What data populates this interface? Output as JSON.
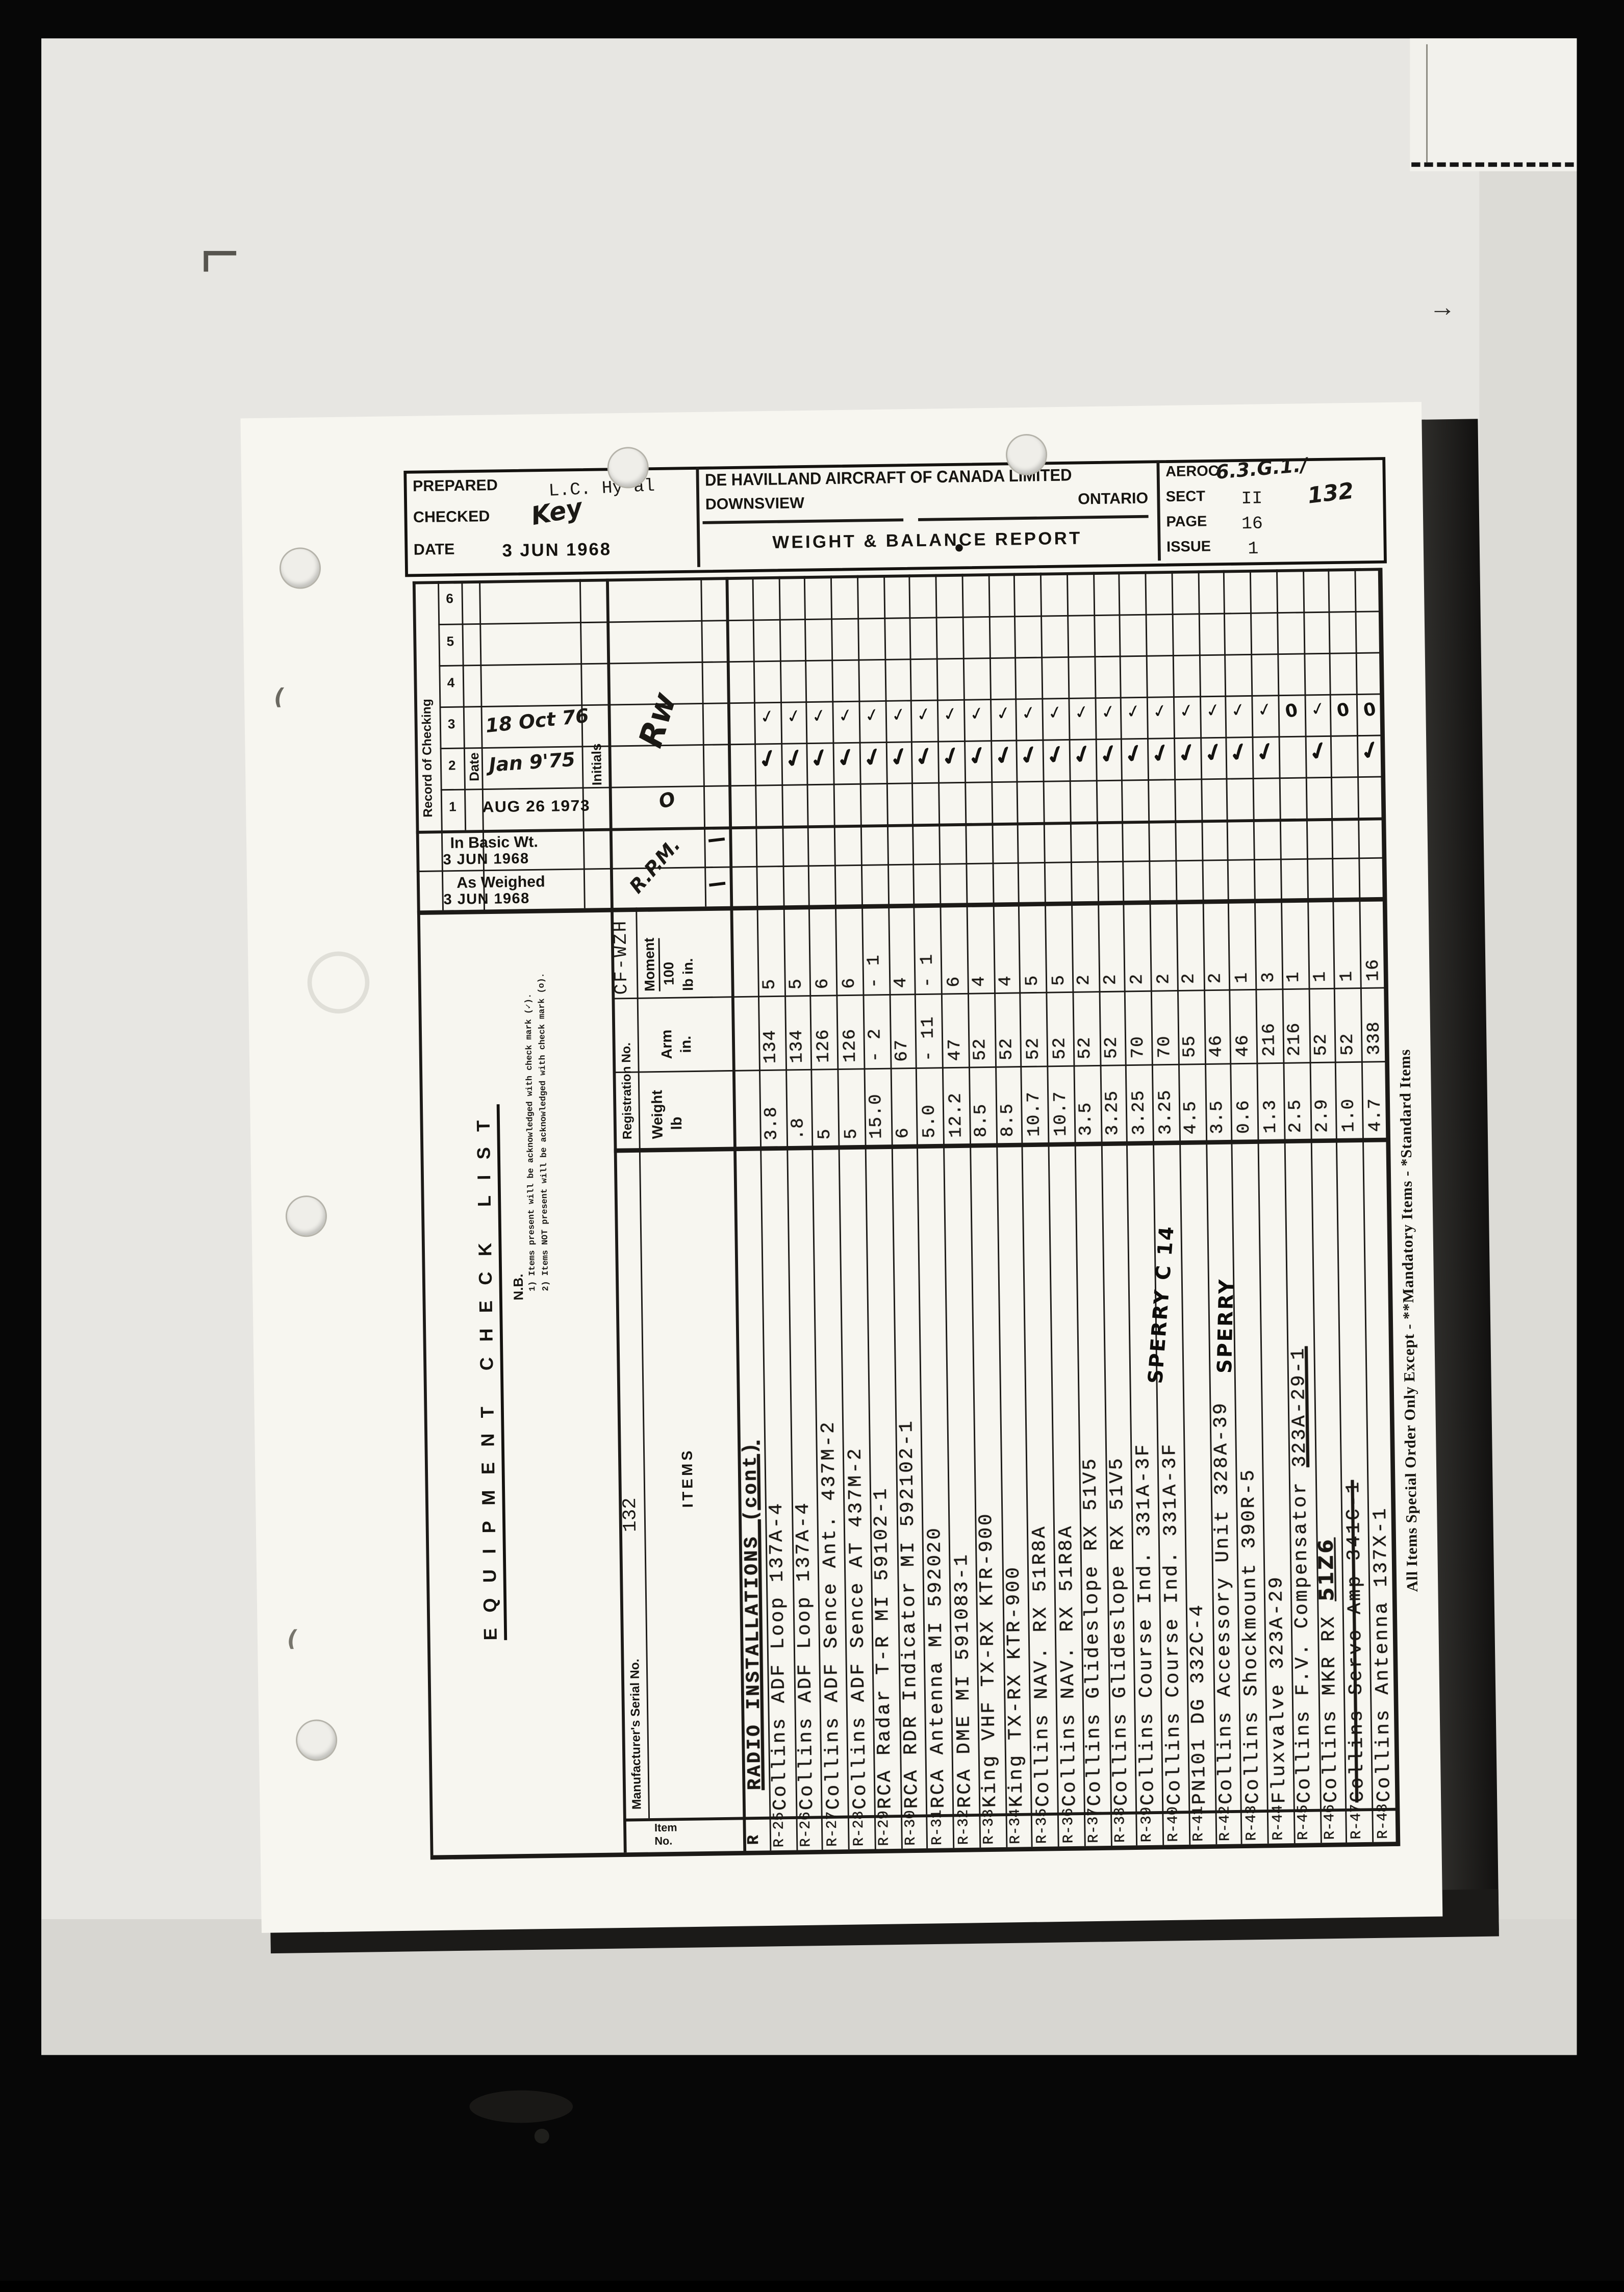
{
  "header": {
    "prepared_label": "PREPARED",
    "prepared_value": "L.C. Hy'al",
    "checked_label": "CHECKED",
    "checked_value": "Key",
    "date_label": "DATE",
    "date_value": "3 JUN 1968",
    "company": "DE HAVILLAND AIRCRAFT OF CANADA LIMITED",
    "city": "DOWNSVIEW",
    "province": "ONTARIO",
    "report_title": "WEIGHT & BALANCE REPORT",
    "ref_label": "AEROC",
    "ref_value": "6.3.G.1./",
    "sect_label": "SECT",
    "sect_value": "II",
    "serial_note": "132",
    "page_label": "PAGE",
    "page_value": "16",
    "issue_label": "ISSUE",
    "issue_value": "1"
  },
  "check_block": {
    "title": "Record of Checking",
    "col_numbers": [
      "6",
      "5",
      "4",
      "3",
      "2",
      "1"
    ],
    "date_label": "Date",
    "initials_label": "Initials",
    "date_3": "18 Oct 76",
    "date_2": "Jan 9'75",
    "date_1": "AUG 26 1973",
    "in_basic_label": "In Basic Wt.",
    "in_basic_date": "3 JUN 1968",
    "as_weighed_label": "As Weighed",
    "as_weighed_date": "3 JUN 1968",
    "initials_sig": "Rw",
    "initials_mark": "O",
    "initials_rpm": "R.P.M."
  },
  "notes": {
    "title": "EQUIPMENT CHECK LIST",
    "nb": "N.B.",
    "line1": "1) Items present will be acknowledged with check mark (✓).",
    "line2": "2) Items NOT present will be acknowledged with check mark (o)."
  },
  "marks": {
    "check_glyph": "✓",
    "zero_glyph": "0",
    "arrow": "→",
    "paren": "("
  },
  "table": {
    "registration_label": "Registration No.",
    "registration_value": "CF-WZH",
    "serial_label": "Manufacturer's Serial No.",
    "serial_value": "132",
    "items_label": "ITEMS",
    "item_no_label_1": "Item",
    "item_no_label_2": "No.",
    "weight_label1": "Weight",
    "weight_label2": "lb",
    "arm_label1": "Arm",
    "arm_label2": "in.",
    "moment_label1": "Moment",
    "moment_label2": "100",
    "moment_label3": "lb in.",
    "section_no": "R",
    "section_name": "RADIO INSTALLATIONS (cont)",
    "footnote": "All Items Special Order Only Except - **Mandatory Items - *Standard Items",
    "annotations": [
      {
        "text": "SPERRY C 14"
      },
      {
        "text": "SPERRY"
      }
    ],
    "items": [
      {
        "no": "R-25",
        "name": "Collins ADF Loop 137A-4",
        "weight": "3.8",
        "arm": "134",
        "moment": "5",
        "c76": "check",
        "c75": "check"
      },
      {
        "no": "R-26",
        "name": "Collins ADF Loop 137A-4",
        "weight": ".8",
        "arm": "134",
        "moment": "5",
        "c76": "check",
        "c75": "check"
      },
      {
        "no": "R-27",
        "name": "Collins ADF Sence Ant. 437M-2",
        "weight": "5",
        "arm": "126",
        "moment": "6",
        "c76": "check",
        "c75": "check"
      },
      {
        "no": "R-28",
        "name": "Collins ADF Sence AT 437M-2",
        "weight": "5",
        "arm": "126",
        "moment": "6",
        "c76": "check",
        "c75": "check"
      },
      {
        "no": "R-29",
        "name": "RCA Radar T-R MI 59102-1",
        "weight": "15.0",
        "arm": "- 2",
        "moment": "- 1",
        "c76": "check",
        "c75": "check"
      },
      {
        "no": "R-30",
        "name": "RCA RDR Indicator MI 592102-1",
        "weight": "6",
        "arm": "67",
        "moment": "4",
        "c76": "check",
        "c75": "check"
      },
      {
        "no": "R-31",
        "name": "RCA Antenna MI 592020",
        "weight": "5.0",
        "arm": "- 11",
        "moment": "- 1",
        "c76": "check",
        "c75": "check"
      },
      {
        "no": "R-32",
        "name": "RCA DME MI 591083-1",
        "weight": "12.2",
        "arm": "47",
        "moment": "6",
        "c76": "check",
        "c75": "check"
      },
      {
        "no": "R-33",
        "name": "King VHF TX-RX KTR-900",
        "weight": "8.5",
        "arm": "52",
        "moment": "4",
        "c76": "check",
        "c75": "check"
      },
      {
        "no": "R-34",
        "name": "King TX-RX KTR-900",
        "weight": "8.5",
        "arm": "52",
        "moment": "4",
        "c76": "check",
        "c75": "check"
      },
      {
        "no": "R-35",
        "name": "Collins NAV. RX 51R8A",
        "weight": "10.7",
        "arm": "52",
        "moment": "5",
        "c76": "check",
        "c75": "check"
      },
      {
        "no": "R-36",
        "name": "Collins NAV. RX 51R8A",
        "weight": "10.7",
        "arm": "52",
        "moment": "5",
        "c76": "check",
        "c75": "check"
      },
      {
        "no": "R-37",
        "name": "Collins Glideslope RX 51V5",
        "weight": "3.5",
        "arm": "52",
        "moment": "2",
        "c76": "check",
        "c75": "check"
      },
      {
        "no": "R-38",
        "name": "Collins Glideslope RX 51V5",
        "weight": "3.25",
        "arm": "52",
        "moment": "2",
        "c76": "check",
        "c75": "check"
      },
      {
        "no": "R-39",
        "name": "Collins Course Ind. 331A-3F",
        "weight": "3.25",
        "arm": "70",
        "moment": "2",
        "c76": "check",
        "c75": "check"
      },
      {
        "no": "R-40",
        "name": "Collins Course Ind. 331A-3F",
        "weight": "3.25",
        "arm": "70",
        "moment": "2",
        "c76": "check",
        "c75": "check"
      },
      {
        "no": "R-41",
        "name": "PN101 DG 332C-4",
        "weight": "4.5",
        "arm": "55",
        "moment": "2",
        "c76": "check",
        "c75": "check"
      },
      {
        "no": "R-42",
        "name": "Collins Accessory Unit 328A-39",
        "weight": "3.5",
        "arm": "46",
        "moment": "2",
        "c76": "check",
        "c75": "check"
      },
      {
        "no": "R-43",
        "name": "Collins Shockmount 390R-5",
        "weight": "0.6",
        "arm": "46",
        "moment": "1",
        "c76": "check",
        "c75": "check"
      },
      {
        "no": "R-44",
        "name": "Fluxvalve 323A-29",
        "weight": "1.3",
        "arm": "216",
        "moment": "3",
        "c76": "check",
        "c75": "check"
      },
      {
        "no": "R-45",
        "name": "Collins F.V. Compensator 323A-29-1",
        "upart": "323A-29-1",
        "weight": "2.5",
        "arm": "216",
        "moment": "1",
        "c76": "zero",
        "c75": ""
      },
      {
        "no": "R-46",
        "name": "Collins MKR RX 51Z6",
        "handpart": "51Z6",
        "weight": "2.9",
        "arm": "52",
        "moment": "1",
        "c76": "check",
        "c75": "check"
      },
      {
        "no": "R-47",
        "name": "Collins Servo Amp 341C-1",
        "strike": true,
        "weight": "1.0",
        "arm": "52",
        "moment": "1",
        "c76": "zero",
        "c75": ""
      },
      {
        "no": "R-48",
        "name": "Collins Antenna 137X-1",
        "weight": "4.7",
        "arm": "338",
        "moment": "16",
        "c76": "zero",
        "c75": "check"
      }
    ]
  }
}
